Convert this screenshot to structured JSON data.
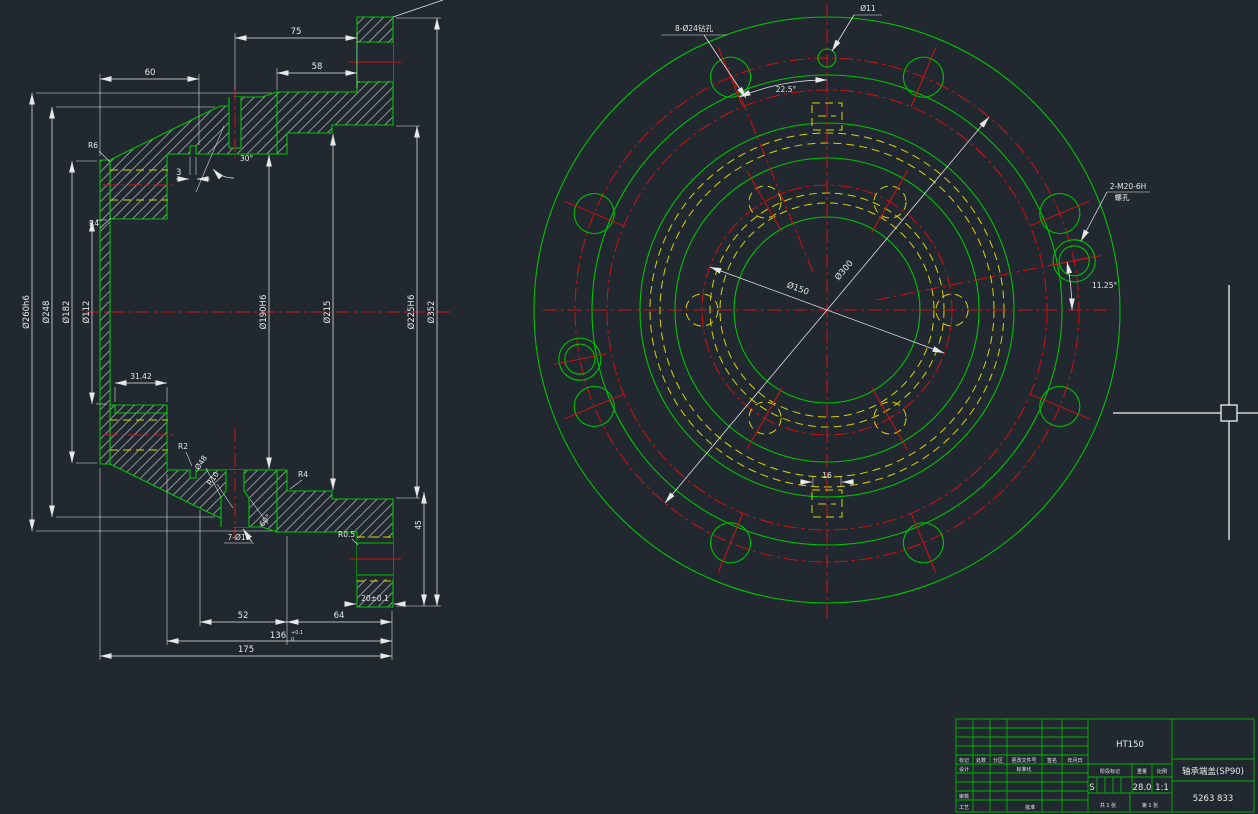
{
  "app": {
    "background": "#212830"
  },
  "colors": {
    "outline": "#00c400",
    "centerline": "#d01212",
    "hidden": "#d8d400",
    "dimension": "#e8e8e8"
  },
  "left_view": {
    "dims": {
      "top_width": "75",
      "spigot_width": "58",
      "hub_width": "60",
      "groove_width": "3",
      "angle_30": "30°",
      "od_spigot": "Ø260h6",
      "od_cone": "Ø248",
      "od_body": "Ø182",
      "bore_small": "Ø112",
      "bore_mid": "Ø190H6",
      "bore_215": "Ø215",
      "bore_225": "Ø225H6",
      "flange_od": "Ø352",
      "arc_groove": "31.42",
      "len_52": "52",
      "len_64": "64",
      "len_136": "136",
      "tol_136_sup": "+0.1",
      "tol_136_sub": "0",
      "len_175": "175",
      "flange_thk": "20±0.1",
      "flange_side": "45",
      "r6": "R6",
      "r4_top": "R4",
      "r4_mid": "R4",
      "r2": "R2",
      "r05": "R0.5",
      "d48": "Ø48",
      "r10": "R10",
      "angle_60": "60°",
      "holes": "7-Ø18"
    }
  },
  "right_view": {
    "labels": {
      "hole_top": "Ø11",
      "holes_8": "8-Ø24钻孔",
      "tapped": "2-M20-6H",
      "tapped2": "螺孔",
      "angle_225": "22.5°",
      "angle_1125": "11.25°",
      "bc_inner": "Ø150",
      "bc_outer": "Ø300",
      "keyway": "16"
    }
  },
  "title_block": {
    "material": "HT150",
    "part_name": "轴承端盖(SP90)",
    "drawing_no": "5263 833",
    "stage_label": "阶段标记",
    "stage_value": "S",
    "weight_label": "重量",
    "weight": "28.0",
    "scale_label": "比例",
    "scale": "1:1",
    "sheet_total": "共 1 张",
    "sheet_no": "第 1 张",
    "col_mark": "标记",
    "col_count": "处数",
    "col_zone": "分区",
    "col_doc": "更改文件号",
    "col_sign": "签名",
    "col_date": "年月日",
    "row_design": "设计",
    "row_std": "标准化",
    "row_audit": "审核",
    "row_process": "工艺",
    "row_approve": "批准"
  }
}
